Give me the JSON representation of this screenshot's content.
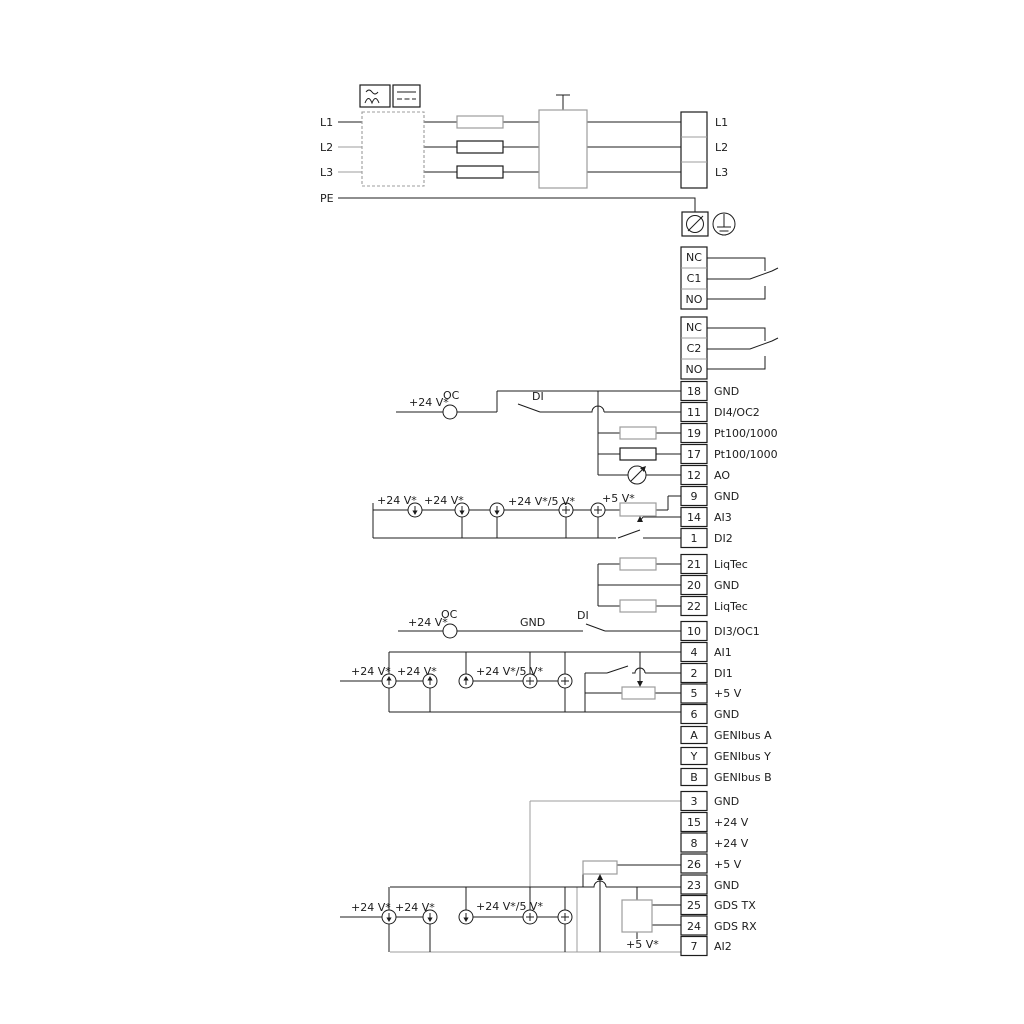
{
  "mains": {
    "in": [
      "L1",
      "L2",
      "L3",
      "PE"
    ],
    "out": [
      "L1",
      "L2",
      "L3"
    ]
  },
  "relay1": [
    "NC",
    "C1",
    "NO"
  ],
  "relay2": [
    "NC",
    "C2",
    "NO"
  ],
  "g1": [
    {
      "n": "18",
      "t": "GND"
    },
    {
      "n": "11",
      "t": "DI4/OC2"
    },
    {
      "n": "19",
      "t": "Pt100/1000"
    },
    {
      "n": "17",
      "t": "Pt100/1000"
    },
    {
      "n": "12",
      "t": "AO"
    },
    {
      "n": "9",
      "t": "GND"
    },
    {
      "n": "14",
      "t": "AI3"
    },
    {
      "n": "1",
      "t": "DI2"
    }
  ],
  "liq": [
    {
      "n": "21",
      "t": "LiqTec"
    },
    {
      "n": "20",
      "t": "GND"
    },
    {
      "n": "22",
      "t": "LiqTec"
    }
  ],
  "g2": [
    {
      "n": "10",
      "t": "DI3/OC1"
    },
    {
      "n": "4",
      "t": "AI1"
    },
    {
      "n": "2",
      "t": "DI1"
    },
    {
      "n": "5",
      "t": "+5 V"
    },
    {
      "n": "6",
      "t": "GND"
    }
  ],
  "geni": [
    {
      "n": "A",
      "t": "GENIbus A"
    },
    {
      "n": "Y",
      "t": "GENIbus Y"
    },
    {
      "n": "B",
      "t": "GENIbus B"
    }
  ],
  "g3": [
    {
      "n": "3",
      "t": "GND"
    },
    {
      "n": "15",
      "t": "+24 V"
    },
    {
      "n": "8",
      "t": "+24 V"
    },
    {
      "n": "26",
      "t": "+5 V"
    },
    {
      "n": "23",
      "t": "GND"
    },
    {
      "n": "25",
      "t": "GDS TX"
    },
    {
      "n": "24",
      "t": "GDS RX"
    },
    {
      "n": "7",
      "t": "AI2"
    }
  ],
  "ann": {
    "v24": "+24 V*",
    "v24_5": "+24 V*/5 V*",
    "v5": "+5 V*",
    "oc": "OC",
    "di": "DI",
    "gnd": "GND"
  },
  "colors": {
    "line": "#1c1c1c",
    "gray": "#9c9c9c"
  }
}
